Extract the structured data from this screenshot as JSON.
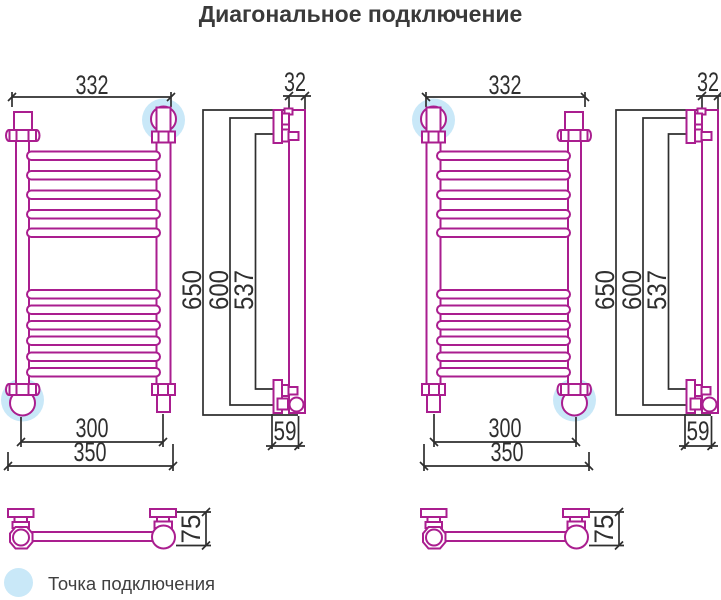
{
  "title": "Диагональное подключение",
  "legend": {
    "label": "Точка подключения"
  },
  "colors": {
    "drawing": "#aa1e8f",
    "dimension": "#2f2f2f",
    "highlight": "#c9e8f8",
    "title": "#3a3a3a"
  },
  "dimensions": {
    "top_width": "332",
    "pipe_width": "32",
    "height_overall": "650",
    "height_mounting": "600",
    "height_inner": "537",
    "bottom_width_inner": "300",
    "bottom_width_outer": "350",
    "wall_offset": "59",
    "depth": "75"
  }
}
